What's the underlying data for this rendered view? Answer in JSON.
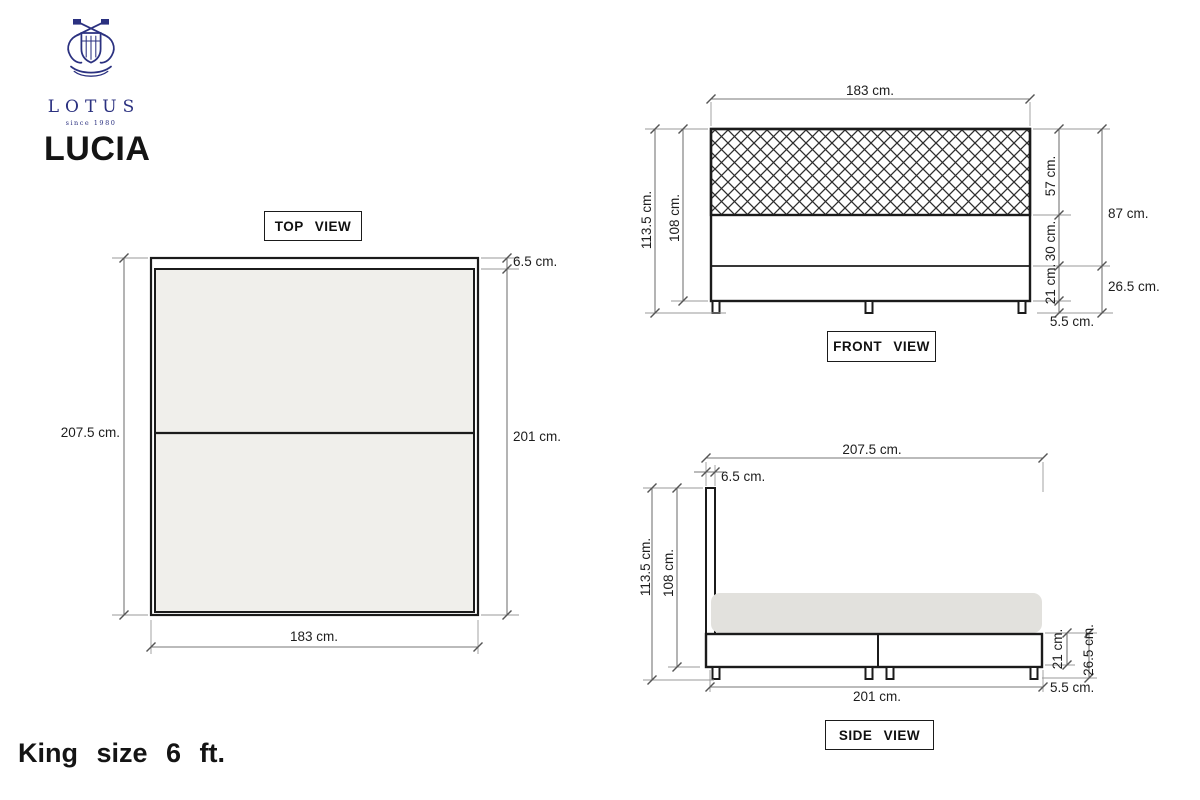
{
  "brand": {
    "logo_name": "LOTUS",
    "logo_tagline": "since 1980",
    "model_name": "LUCIA",
    "size_caption": "King size 6 ft.",
    "logo_color": "#2b3180"
  },
  "top_view": {
    "label": "TOP VIEW",
    "dim_total_length": "207.5 cm.",
    "dim_headboard_thickness": "6.5 cm.",
    "dim_mattress_length": "201 cm.",
    "dim_width": "183 cm."
  },
  "front_view": {
    "label": "FRONT VIEW",
    "dim_width": "183 cm.",
    "dim_total_height": "113.5 cm.",
    "dim_height_no_legs": "108 cm.",
    "dim_headboard_height": "57 cm.",
    "dim_upper_base_height": "30 cm.",
    "dim_lower_base_height": "21 cm.",
    "dim_headboard_plus_upper": "87 cm.",
    "dim_base_with_legs": "26.5 cm.",
    "dim_leg_height": "5.5 cm."
  },
  "side_view": {
    "label": "SIDE VIEW",
    "dim_total_length": "207.5 cm.",
    "dim_headboard_thickness": "6.5 cm.",
    "dim_total_height": "113.5 cm.",
    "dim_height_no_legs": "108 cm.",
    "dim_base_height": "21 cm.",
    "dim_base_with_legs": "26.5 cm.",
    "dim_base_length": "201 cm.",
    "dim_leg_height": "5.5 cm."
  },
  "colors": {
    "mattress_gray": "#e2e1dd",
    "top_view_fill": "#f0efeb",
    "object_line": "#1b1b1b",
    "dimension_line": "#777777"
  }
}
